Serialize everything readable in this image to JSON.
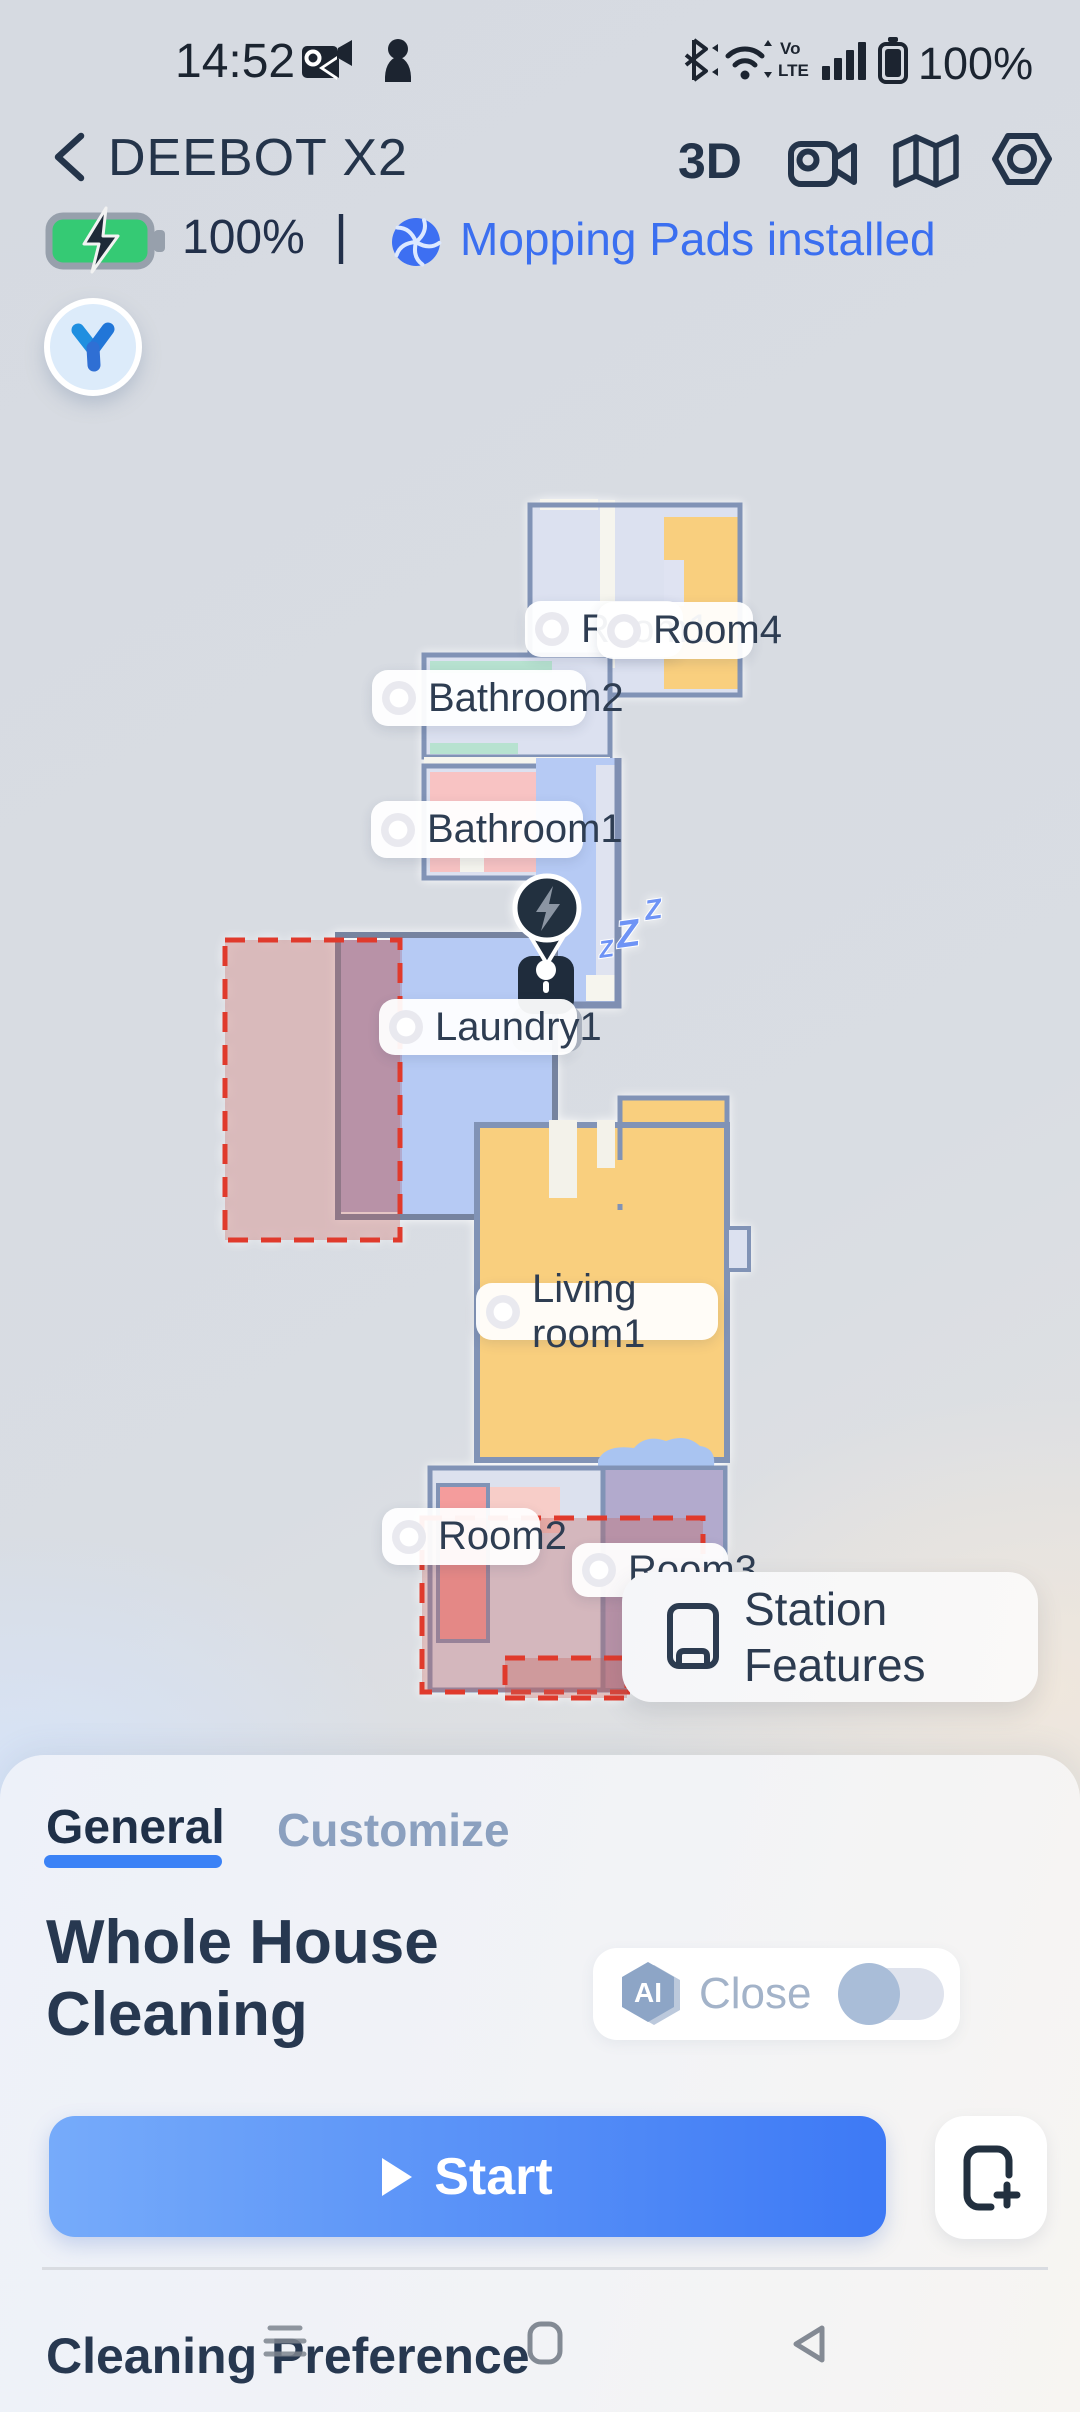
{
  "status": {
    "time": "14:52",
    "battery_pct": "100%",
    "volte_line1": "Vo",
    "volte_line2": "LTE"
  },
  "header": {
    "title": "DEEBOT X2",
    "mode_3d": "3D"
  },
  "robot": {
    "battery": "100%",
    "divider": "|",
    "mop_status": "Mopping Pads installed"
  },
  "map": {
    "sleep_glyph": "Z",
    "rooms": [
      {
        "label": "Room1"
      },
      {
        "label": "Room4"
      },
      {
        "label": "Bathroom2"
      },
      {
        "label": "Bathroom1"
      },
      {
        "label": "Laundry1"
      },
      {
        "label": "Living room1"
      },
      {
        "label": "Room2"
      },
      {
        "label": "Room3"
      }
    ],
    "tooltip": {
      "line1": "Station",
      "line2": "Features"
    }
  },
  "sheet": {
    "tabs": {
      "general": "General",
      "customize": "Customize"
    },
    "title_line1": "Whole House",
    "title_line2": "Cleaning",
    "ai_badge": "AI",
    "ai_state": "Close",
    "start_label": "Start",
    "section_title": "Cleaning Preference"
  },
  "colors": {
    "accent_blue": "#3b82f6",
    "link_blue": "#3b6ff0",
    "start_gradient_from": "#76abfa",
    "start_gradient_to": "#3d79f5",
    "room_yellow": "#f9cf7e",
    "room_blue": "#b6caf4",
    "room_pink": "#f8c3c3",
    "room_purple": "#b2aacd",
    "room_lavender": "#dce1f0",
    "wall": "#8193b6",
    "nogo_red": "#e03a2c",
    "battery_green": "#35ca74",
    "dark_navy": "#24344a"
  }
}
